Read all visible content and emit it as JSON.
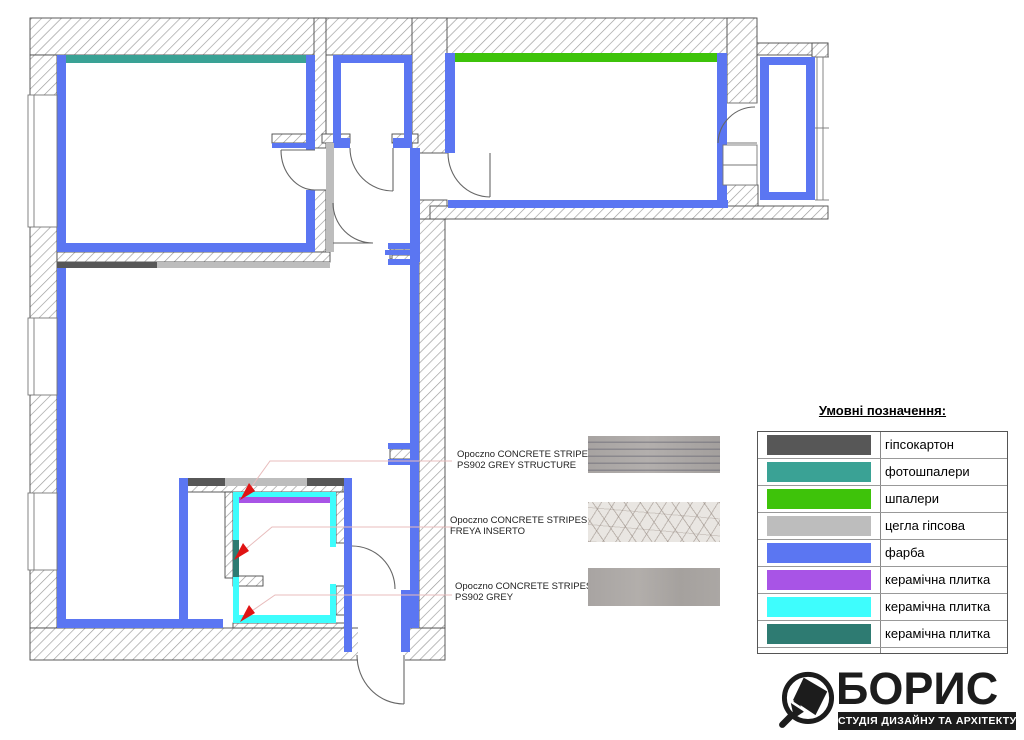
{
  "colors": {
    "blue": "#5B76F2",
    "teal": "#3AA295",
    "green": "#3EC30A",
    "lgray": "#BDBDBD",
    "dgray": "#575757",
    "purple": "#A854E6",
    "cyan": "#3EFDFD",
    "dteal": "#2E7B72",
    "hatch": "#9a9a9a",
    "outline": "#4a4a4a",
    "leader": "#E8BCBC",
    "arrow": "#E01414"
  },
  "legend": {
    "title": "Умовні позначення:",
    "rows": [
      {
        "label": "гіпсокартон",
        "color": "#575757"
      },
      {
        "label": "фотошпалери",
        "color": "#3AA295"
      },
      {
        "label": "шпалери",
        "color": "#3EC30A"
      },
      {
        "label": "цегла гіпсова",
        "color": "#BDBDBD"
      },
      {
        "label": "фарба",
        "color": "#5B76F2"
      },
      {
        "label": "керамічна плитка",
        "color": "#A854E6"
      },
      {
        "label": "керамічна плитка",
        "color": "#3EFDFD"
      },
      {
        "label": "керамічна плитка",
        "color": "#2E7B72"
      }
    ]
  },
  "materials": [
    {
      "brand": "Opoczno CONCRETE STRIPES",
      "variant": "PS902 GREY STRUCTURE"
    },
    {
      "brand": "Opoczno CONCRETE STRIPES",
      "variant": "FREYA  INSERTO"
    },
    {
      "brand": "Opoczno CONCRETE STRIPES",
      "variant": "PS902 GREY"
    }
  ],
  "logo": {
    "name": "БОРИС",
    "tagline": "СТУДІЯ ДИЗАЙНУ ТА АРХІТЕКТУРИ"
  }
}
